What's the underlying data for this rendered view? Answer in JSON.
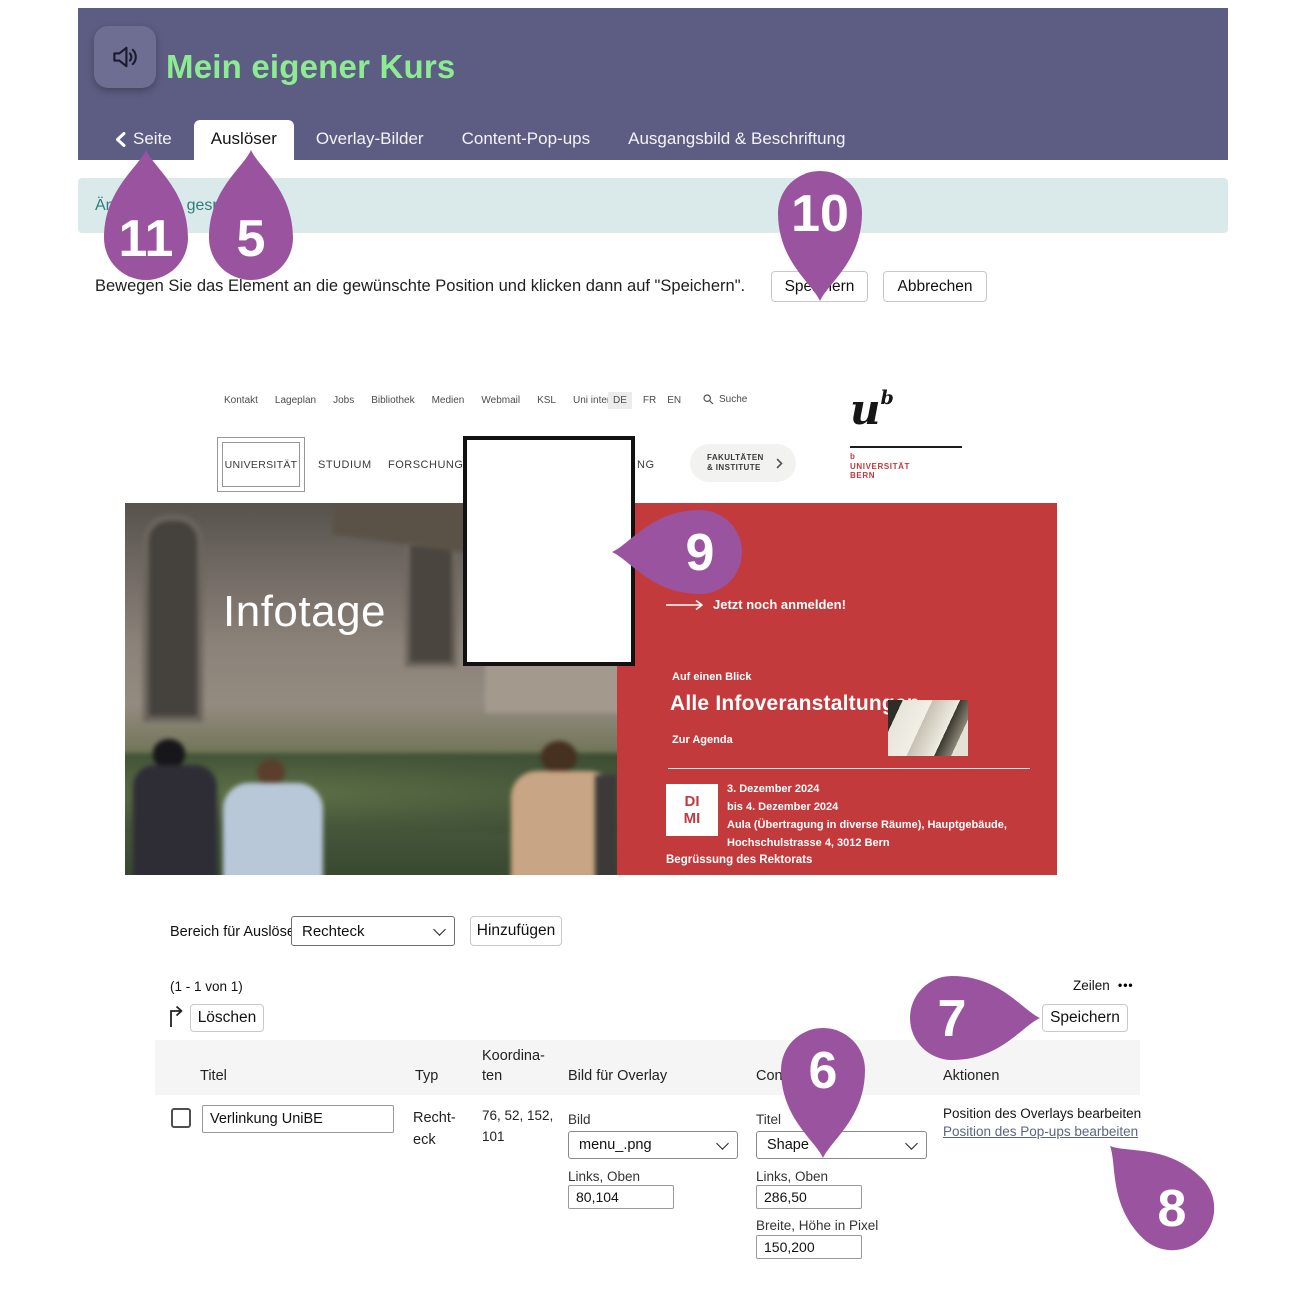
{
  "header": {
    "title": "Mein eigener Kurs",
    "back_label": "Seite",
    "tabs": [
      "Auslöser",
      "Overlay-Bilder",
      "Content-Pop-ups",
      "Ausgangsbild & Beschriftung"
    ],
    "active_tab": "Auslöser"
  },
  "notification": {
    "text": "Änderungen gespeichert"
  },
  "toolbar": {
    "instruction": "Bewegen Sie das Element an die gewünschte Position und klicken dann auf \"Speichern\".",
    "save_label": "Speichern",
    "cancel_label": "Abbrechen"
  },
  "website": {
    "utility_nav": [
      "Kontakt",
      "Lageplan",
      "Jobs",
      "Bibliothek",
      "Medien",
      "Webmail",
      "KSL",
      "Uni intern"
    ],
    "languages": [
      "DE",
      "FR",
      "EN"
    ],
    "active_language": "DE",
    "search_label": "Suche",
    "main_nav": [
      "UNIVERSITÄT",
      "STUDIUM",
      "FORSCHUNG"
    ],
    "main_nav_fragment": "NG",
    "faculties_line1": "FAKULTÄTEN",
    "faculties_line2": "& INSTITUTE",
    "logo_u": "u",
    "logo_b": "b",
    "logo_sub": "b\nUNIVERSITÄT\nBERN",
    "hero_title": "Infotage",
    "red_panel": {
      "cta": "Jetzt noch anmelden!",
      "kicker": "Auf einen Blick",
      "heading": "Alle Infoveranstaltungen",
      "agenda_link": "Zur Agenda",
      "badge_line1": "DI",
      "badge_line2": "MI",
      "event_lines": "3. Dezember 2024\nbis 4. Dezember 2024\nAula (Übertragung in diverse Räume), Hauptgebäude,\nHochschulstrasse 4, 3012 Bern",
      "footer_link": "Begrüssung des Rektorats"
    }
  },
  "trigger_form": {
    "label": "Bereich für Auslöser",
    "shape_value": "Rechteck",
    "add_label": "Hinzufügen"
  },
  "table": {
    "pagination": "(1 - 1 von 1)",
    "rows_label": "Zeilen",
    "rows_dots": "•••",
    "delete_label": "Löschen",
    "save_label": "Speichern",
    "columns": {
      "titel": "Titel",
      "typ": "Typ",
      "koordinaten": "Koordina-\nten",
      "bild": "Bild für Overlay",
      "content": "Content-Pop-up",
      "aktionen": "Aktionen"
    },
    "row": {
      "titel_value": "Verlinkung UniBE",
      "typ_value": "Recht-\neck",
      "koordinaten_value": "76, 52, 152,\n101",
      "bild_label": "Bild",
      "bild_select": "menu_.png",
      "bild_pos_label": "Links, Oben",
      "bild_pos_value": "80,104",
      "content_label": "Titel",
      "content_select": "Shape",
      "content_pos_label": "Links, Oben",
      "content_pos_value": "286,50",
      "content_size_label": "Breite, Höhe in Pixel",
      "content_size_value": "150,200",
      "action_overlay": "Position des Overlays bearbeiten",
      "action_popup": "Position des Pop-ups bearbeiten"
    }
  },
  "markers": {
    "m5": "5",
    "m6": "6",
    "m7": "7",
    "m8": "8",
    "m9": "9",
    "m10": "10",
    "m11": "11"
  },
  "colors": {
    "header_bg": "#5d5d83",
    "title_green": "#8dec92",
    "notification_bg": "#daeaea",
    "site_red": "#c23a3c",
    "marker_purple": "#99539f",
    "link_blue": "#5b657e"
  }
}
